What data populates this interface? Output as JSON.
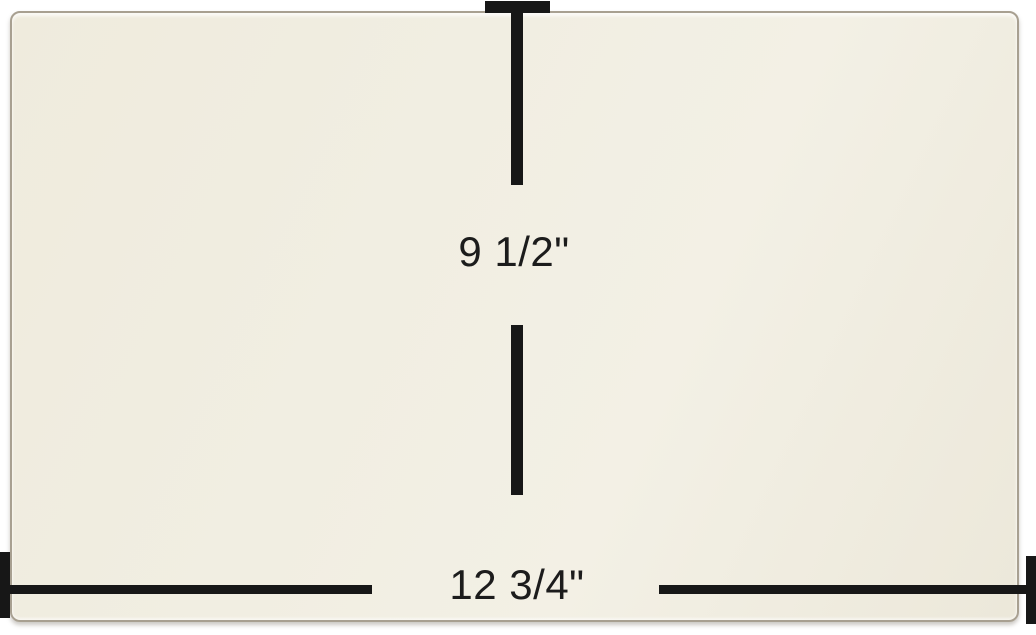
{
  "image": {
    "description_label": "cream panel with dimension annotations",
    "background_color": "#ffffff"
  },
  "panel": {
    "fill_color": "#f0ecdf",
    "edge_color": "#a8a091"
  },
  "dimensions": {
    "line_color": "#171717",
    "text_color": "#1c1c1c",
    "height": {
      "label": "9 1/2\""
    },
    "width": {
      "label": "12 3/4\""
    }
  }
}
